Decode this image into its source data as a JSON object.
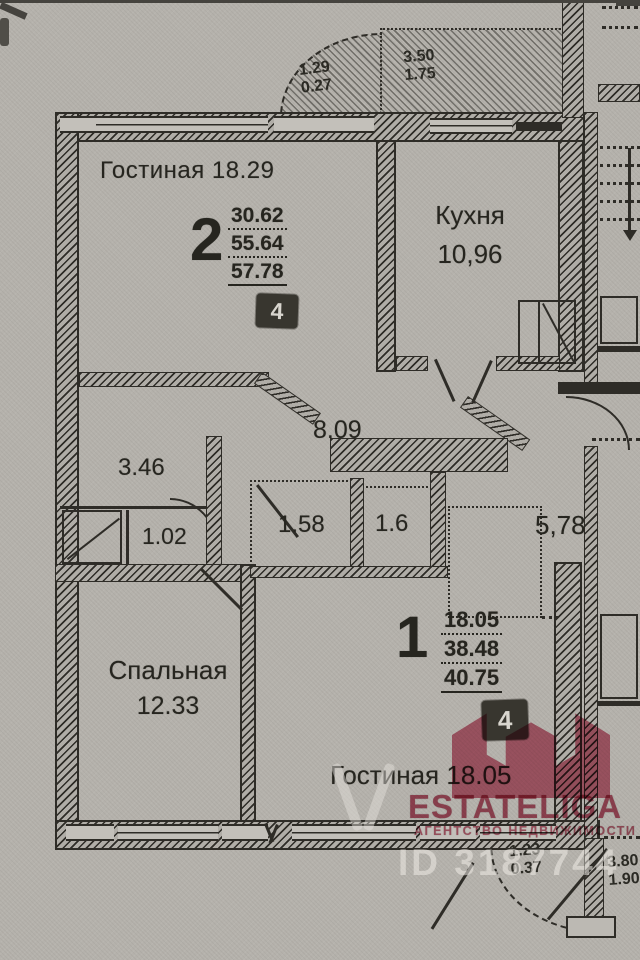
{
  "plan": {
    "rooms": {
      "living2": "Гостиная 18.29",
      "kitchen_name": "Кухня",
      "kitchen_area": "10,96",
      "corridor": "8.09",
      "hall_small": "3.46",
      "bath": "1.02",
      "closet_a": "1.58",
      "closet_b": "1.6",
      "hall_apt1": "5,78",
      "bedroom_name": "Спальная",
      "bedroom_area": "12.33",
      "living1": "Гостиная 18.05"
    },
    "apartments": [
      {
        "number": "2",
        "area_living": "30.62",
        "area_usable": "55.64",
        "area_total": "57.78",
        "badge": "4"
      },
      {
        "number": "1",
        "area_living": "18.05",
        "area_usable": "38.48",
        "area_total": "40.75",
        "badge": "4"
      }
    ],
    "balconies": {
      "top_curved": {
        "l1": "1.29",
        "l2": "0.27"
      },
      "top_main": {
        "l1": "3.50",
        "l2": "1.75"
      },
      "bottom_door": {
        "l1": "1.23",
        "l2": "0.37"
      },
      "bottom_right": {
        "l1": "3.80",
        "l2": "1.90"
      }
    }
  },
  "watermark": {
    "brand": "ESTATELIGA",
    "tagline": "АГЕНТСТВО НЕДВИЖИМОСТИ",
    "listing_id": "ID 3187744",
    "brand_color": "#c7506a"
  },
  "colors": {
    "paper": "#b5b2ac",
    "ink": "#2b2a24",
    "badge_bg": "#38362f",
    "watermark_id": "#eeebe5"
  }
}
